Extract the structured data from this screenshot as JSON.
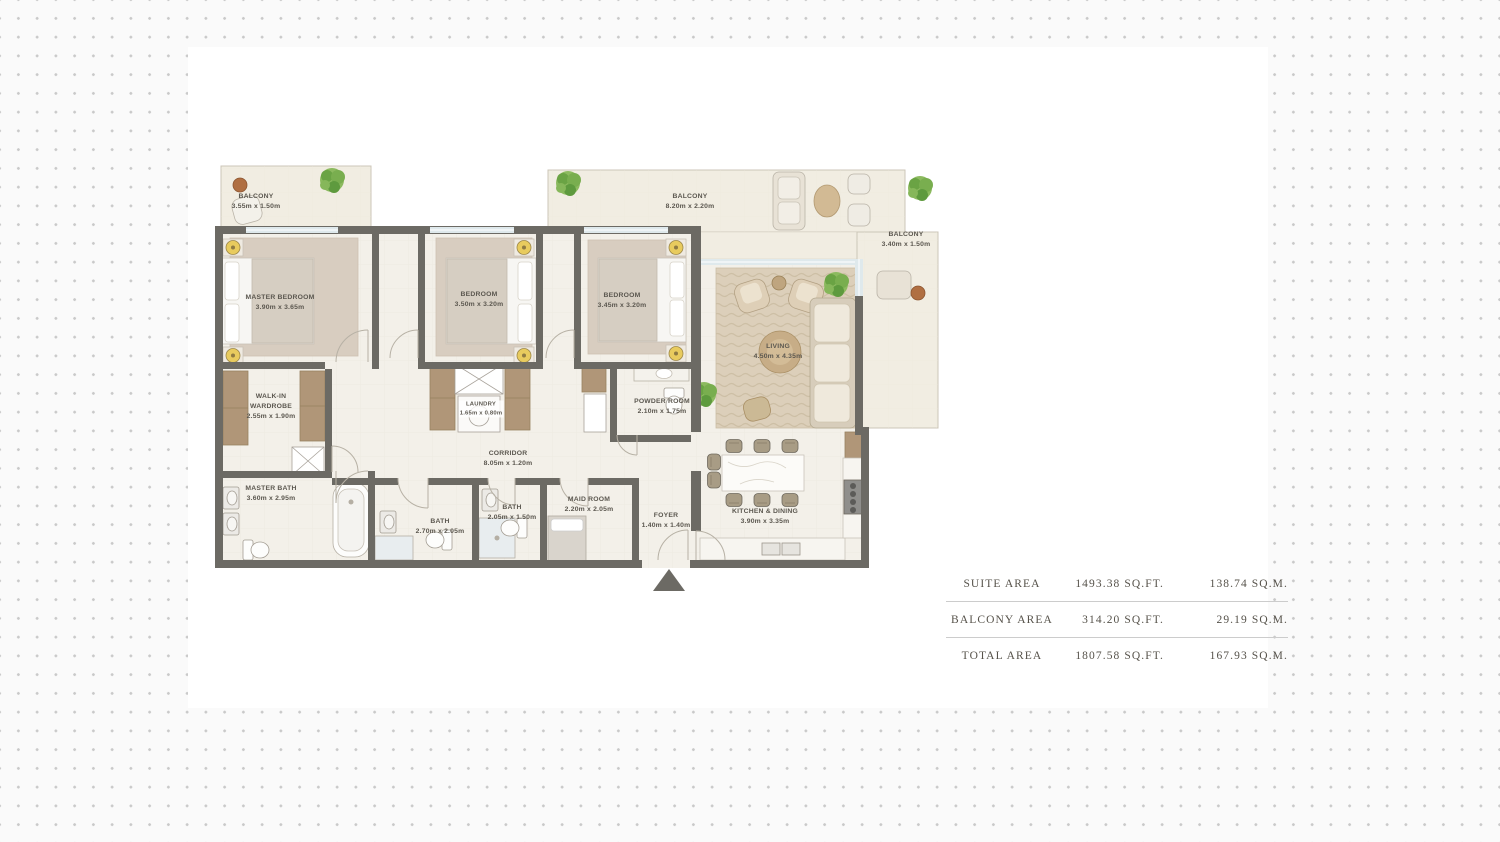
{
  "floor_plan": {
    "balconies": {
      "top_left": {
        "name": "BALCONY",
        "dims": "3.55m x 1.50m"
      },
      "top": {
        "name": "BALCONY",
        "dims": "8.20m x 2.20m"
      },
      "right": {
        "name": "BALCONY",
        "dims": "3.40m x 1.50m"
      }
    },
    "rooms": {
      "master_bedroom": {
        "name": "MASTER BEDROOM",
        "dims": "3.90m x 3.65m"
      },
      "bedroom_2": {
        "name": "BEDROOM",
        "dims": "3.50m x 3.20m"
      },
      "bedroom_3": {
        "name": "BEDROOM",
        "dims": "3.45m x 3.20m"
      },
      "living": {
        "name": "LIVING",
        "dims": "4.50m x 4.35m"
      },
      "walk_in_wardrobe": {
        "name": "WALK-IN WARDROBE",
        "dims": "2.55m x 1.90m"
      },
      "laundry": {
        "name": "LAUNDRY",
        "dims": "1.65m x 0.80m"
      },
      "corridor": {
        "name": "CORRIDOR",
        "dims": "8.05m x 1.20m"
      },
      "powder_room": {
        "name": "POWDER ROOM",
        "dims": "2.10m x 1.75m"
      },
      "master_bath": {
        "name": "MASTER BATH",
        "dims": "3.60m x 2.95m"
      },
      "bath_1": {
        "name": "BATH",
        "dims": "2.70m x 2.05m"
      },
      "bath_2": {
        "name": "BATH",
        "dims": "2.05m x 1.50m"
      },
      "maid_room": {
        "name": "MAID ROOM",
        "dims": "2.20m x 2.05m"
      },
      "foyer": {
        "name": "FOYER",
        "dims": "1.40m x 1.40m"
      },
      "kitchen_dining": {
        "name": "KITCHEN & DINING",
        "dims": "3.90m x 3.35m"
      }
    }
  },
  "area_table": {
    "rows": [
      {
        "label": "SUITE AREA",
        "sqft": "1493.38 SQ.FT.",
        "sqm": "138.74 SQ.M."
      },
      {
        "label": "BALCONY AREA",
        "sqft": "314.20 SQ.FT.",
        "sqm": "29.19 SQ.M."
      },
      {
        "label": "TOTAL AREA",
        "sqft": "1807.58 SQ.FT.",
        "sqm": "167.93 SQ.M."
      }
    ]
  },
  "icons": {
    "entrance_arrow": "triangle-up",
    "plant": "potted-plant"
  },
  "colors": {
    "wall": "#6c6a64",
    "floor": "#f3f0e9",
    "balcony_floor": "#f1ede2",
    "wood": "#b09678",
    "carpet": "#d8cdc0",
    "glass": "#dfe9ec",
    "plant": "#76a653",
    "label_text": "#5b574f",
    "table_text": "#56524a",
    "divider": "#cccccc",
    "background_dot": "#c9c9c9"
  }
}
